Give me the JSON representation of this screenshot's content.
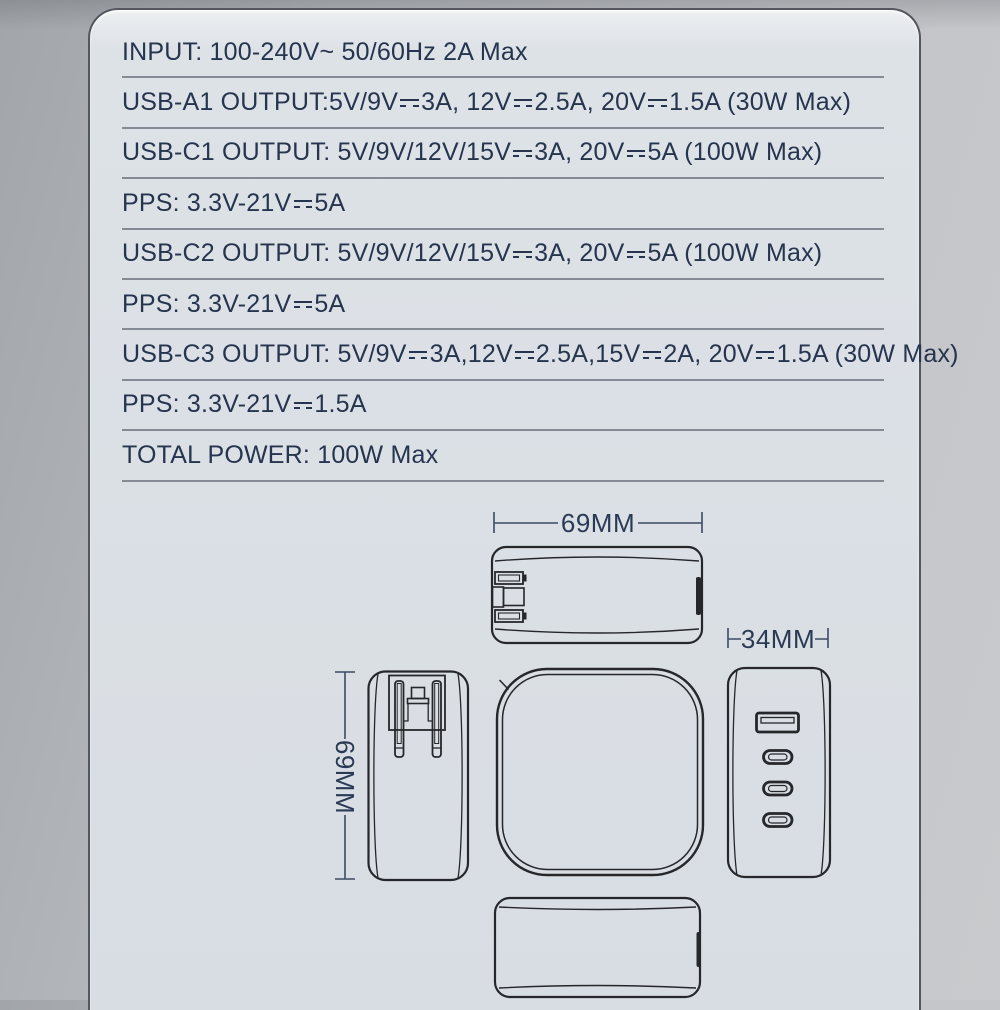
{
  "card": {
    "specs": [
      "INPUT: 100-240V~ 50/60Hz 2A Max",
      "USB-A1 OUTPUT:5V/9V⎓3A, 12V⎓2.5A, 20V⎓1.5A (30W Max)",
      "USB-C1 OUTPUT: 5V/9V/12V/15V⎓3A, 20V⎓5A (100W Max)",
      "PPS: 3.3V-21V⎓5A",
      "USB-C2 OUTPUT: 5V/9V/12V/15V⎓3A, 20V⎓5A (100W Max)",
      "PPS: 3.3V-21V⎓5A",
      "USB-C3 OUTPUT: 5V/9V⎓3A,12V⎓2.5A,15V⎓2A, 20V⎓1.5A (30W Max)",
      "PPS: 3.3V-21V⎓1.5A",
      "TOTAL POWER: 100W Max"
    ]
  },
  "diagram": {
    "width_label": "69MM",
    "height_label": "69MM",
    "depth_label": "34MM",
    "views": [
      "top",
      "side-with-folding-plug",
      "front",
      "ports",
      "bottom"
    ],
    "ports": [
      "USB-A",
      "USB-C",
      "USB-C",
      "USB-C"
    ]
  },
  "colors": {
    "spec_text": "#26344e",
    "divider": "#858b95",
    "drawing_line": "#26272b",
    "dimension_line": "#3c4a63",
    "card_bg": "#d9dee4",
    "card_border": "#54575d",
    "page_bg_left": "#a2a5aa",
    "page_bg_right": "#c8cacd"
  }
}
